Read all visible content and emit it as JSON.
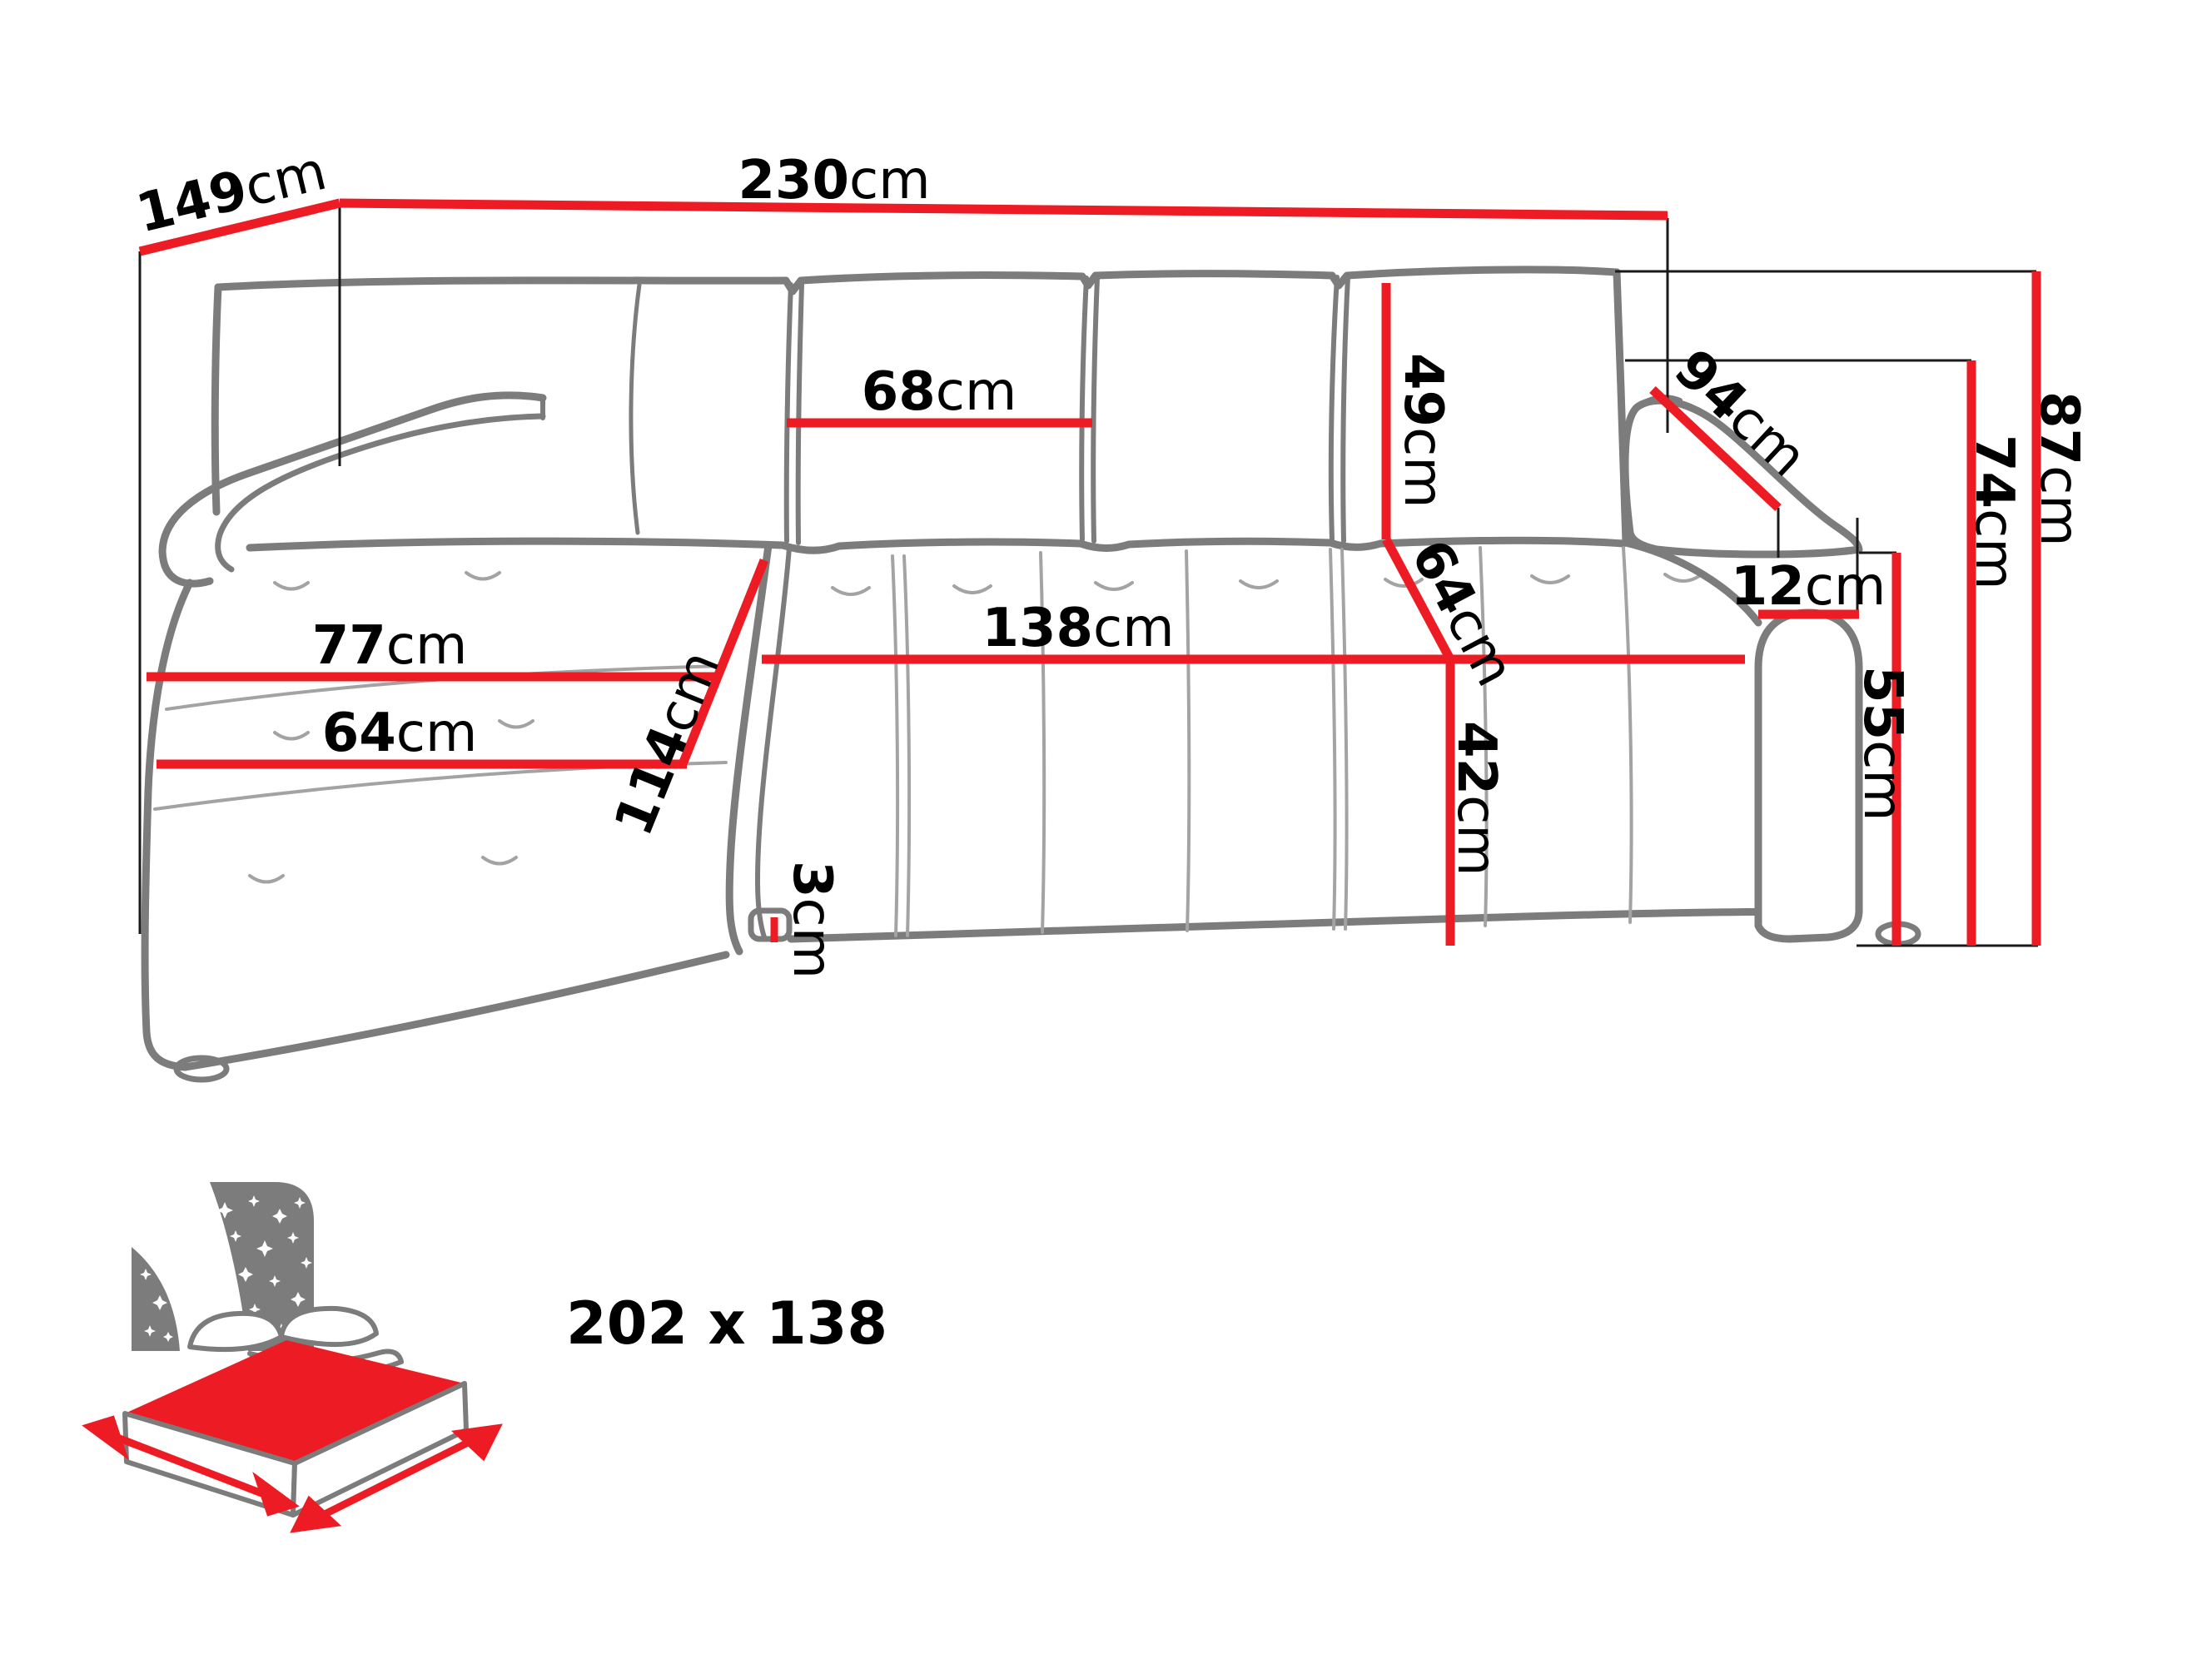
{
  "diagram": {
    "type": "sofa-dimension-drawing",
    "accent_color": "#ed1c24",
    "outline_color": "#7c7c7c",
    "measurements": {
      "total_depth": {
        "value": "149",
        "unit": "cm"
      },
      "total_width": {
        "value": "230",
        "unit": "cm"
      },
      "back_cushion_width": {
        "value": "68",
        "unit": "cm"
      },
      "back_cushion_height": {
        "value": "49",
        "unit": "cm"
      },
      "backrest_depth": {
        "value": "64",
        "unit": "cm"
      },
      "seat_front_width": {
        "value": "138",
        "unit": "cm"
      },
      "seat_height": {
        "value": "42",
        "unit": "cm"
      },
      "chaise_width": {
        "value": "77",
        "unit": "cm"
      },
      "chaise_seat_width": {
        "value": "64",
        "unit": "cm"
      },
      "chaise_length": {
        "value": "114",
        "unit": "cm"
      },
      "armrest_diagonal": {
        "value": "94",
        "unit": "cm"
      },
      "armrest_width": {
        "value": "12",
        "unit": "cm"
      },
      "total_height": {
        "value": "87",
        "unit": "cm"
      },
      "backrest_height": {
        "value": "74",
        "unit": "cm"
      },
      "armrest_height": {
        "value": "55",
        "unit": "cm"
      },
      "ground_clearance": {
        "value": "3",
        "unit": "cm"
      }
    },
    "sleeping_area": {
      "text": "202 x 138"
    }
  }
}
